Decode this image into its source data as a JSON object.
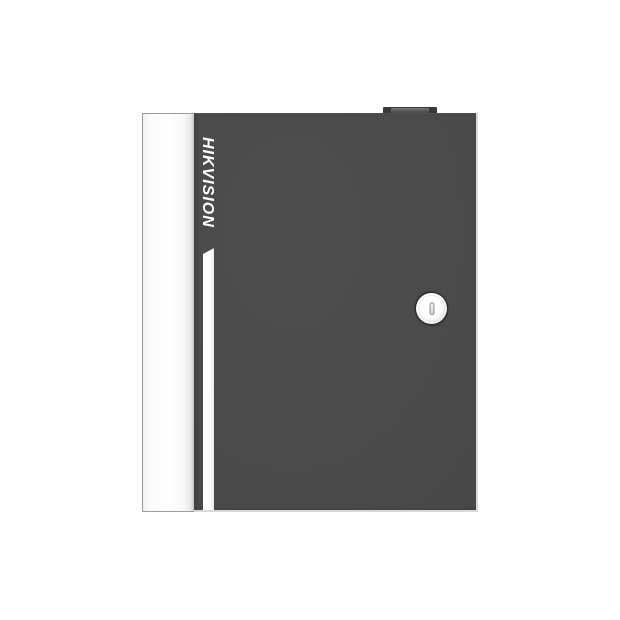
{
  "scene": {
    "type": "product-photo",
    "background_color": "#ffffff"
  },
  "cabinet": {
    "brand": "HIKVISION",
    "colors": {
      "door_body": "#4a4a4b",
      "side_panel": "#fbfbfb",
      "side_panel_border": "#9c9c9c",
      "accent_stripe": "#ffffff",
      "edge_highlight": "#d9d9d9",
      "hinge": "#383838",
      "lock_face": "#f5f5f5",
      "keyhole_slot": "#d4d4d4",
      "logo_text": "#ffffff"
    },
    "features": {
      "lock": "cam-lock-with-vertical-keyhole",
      "hinge": "top-latch-tab",
      "stripe": "vertical-accent-stripe"
    }
  }
}
